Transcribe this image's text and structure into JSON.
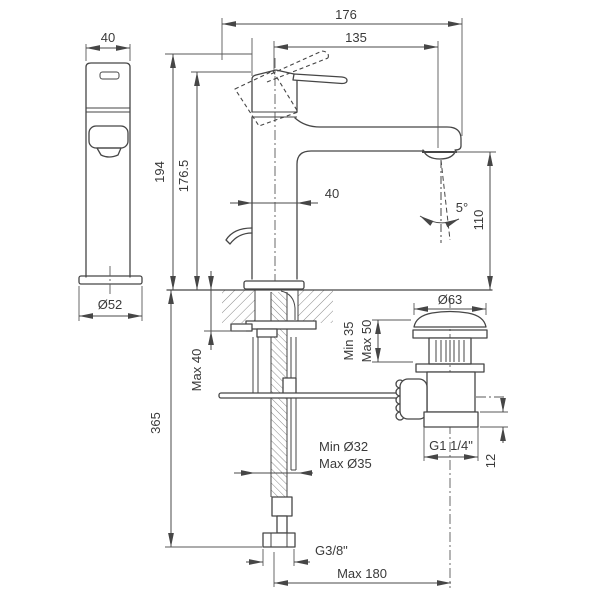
{
  "drawing": {
    "type": "faucet-technical-drawing",
    "views": [
      "side-view",
      "front-view-with-installation-section",
      "drain-assembly"
    ]
  },
  "colors": {
    "background": "#ffffff",
    "line": "#464646",
    "text": "#3a3a3a",
    "hatch": "#7b7b7b"
  },
  "dims": {
    "side_width": "40",
    "side_base_dia": "Ø52",
    "height_total": "194",
    "height_body": "176.5",
    "proj_total": "176",
    "proj_spout": "135",
    "body_width": "40",
    "stream_angle": "5°",
    "spout_height": "110",
    "counter_max_thickness": "Max 40",
    "depth_below_counter": "365",
    "drain_cap_dia": "Ø63",
    "drain_min_depth": "Min 35",
    "drain_max_depth": "Max 50",
    "drain_thread": "G1 1/4\"",
    "drain_thread_height": "12",
    "hole_min_dia": "Min Ø32",
    "hole_max_dia": "Max Ø35",
    "hose_thread": "G3/8\"",
    "reach_max": "Max 180"
  }
}
